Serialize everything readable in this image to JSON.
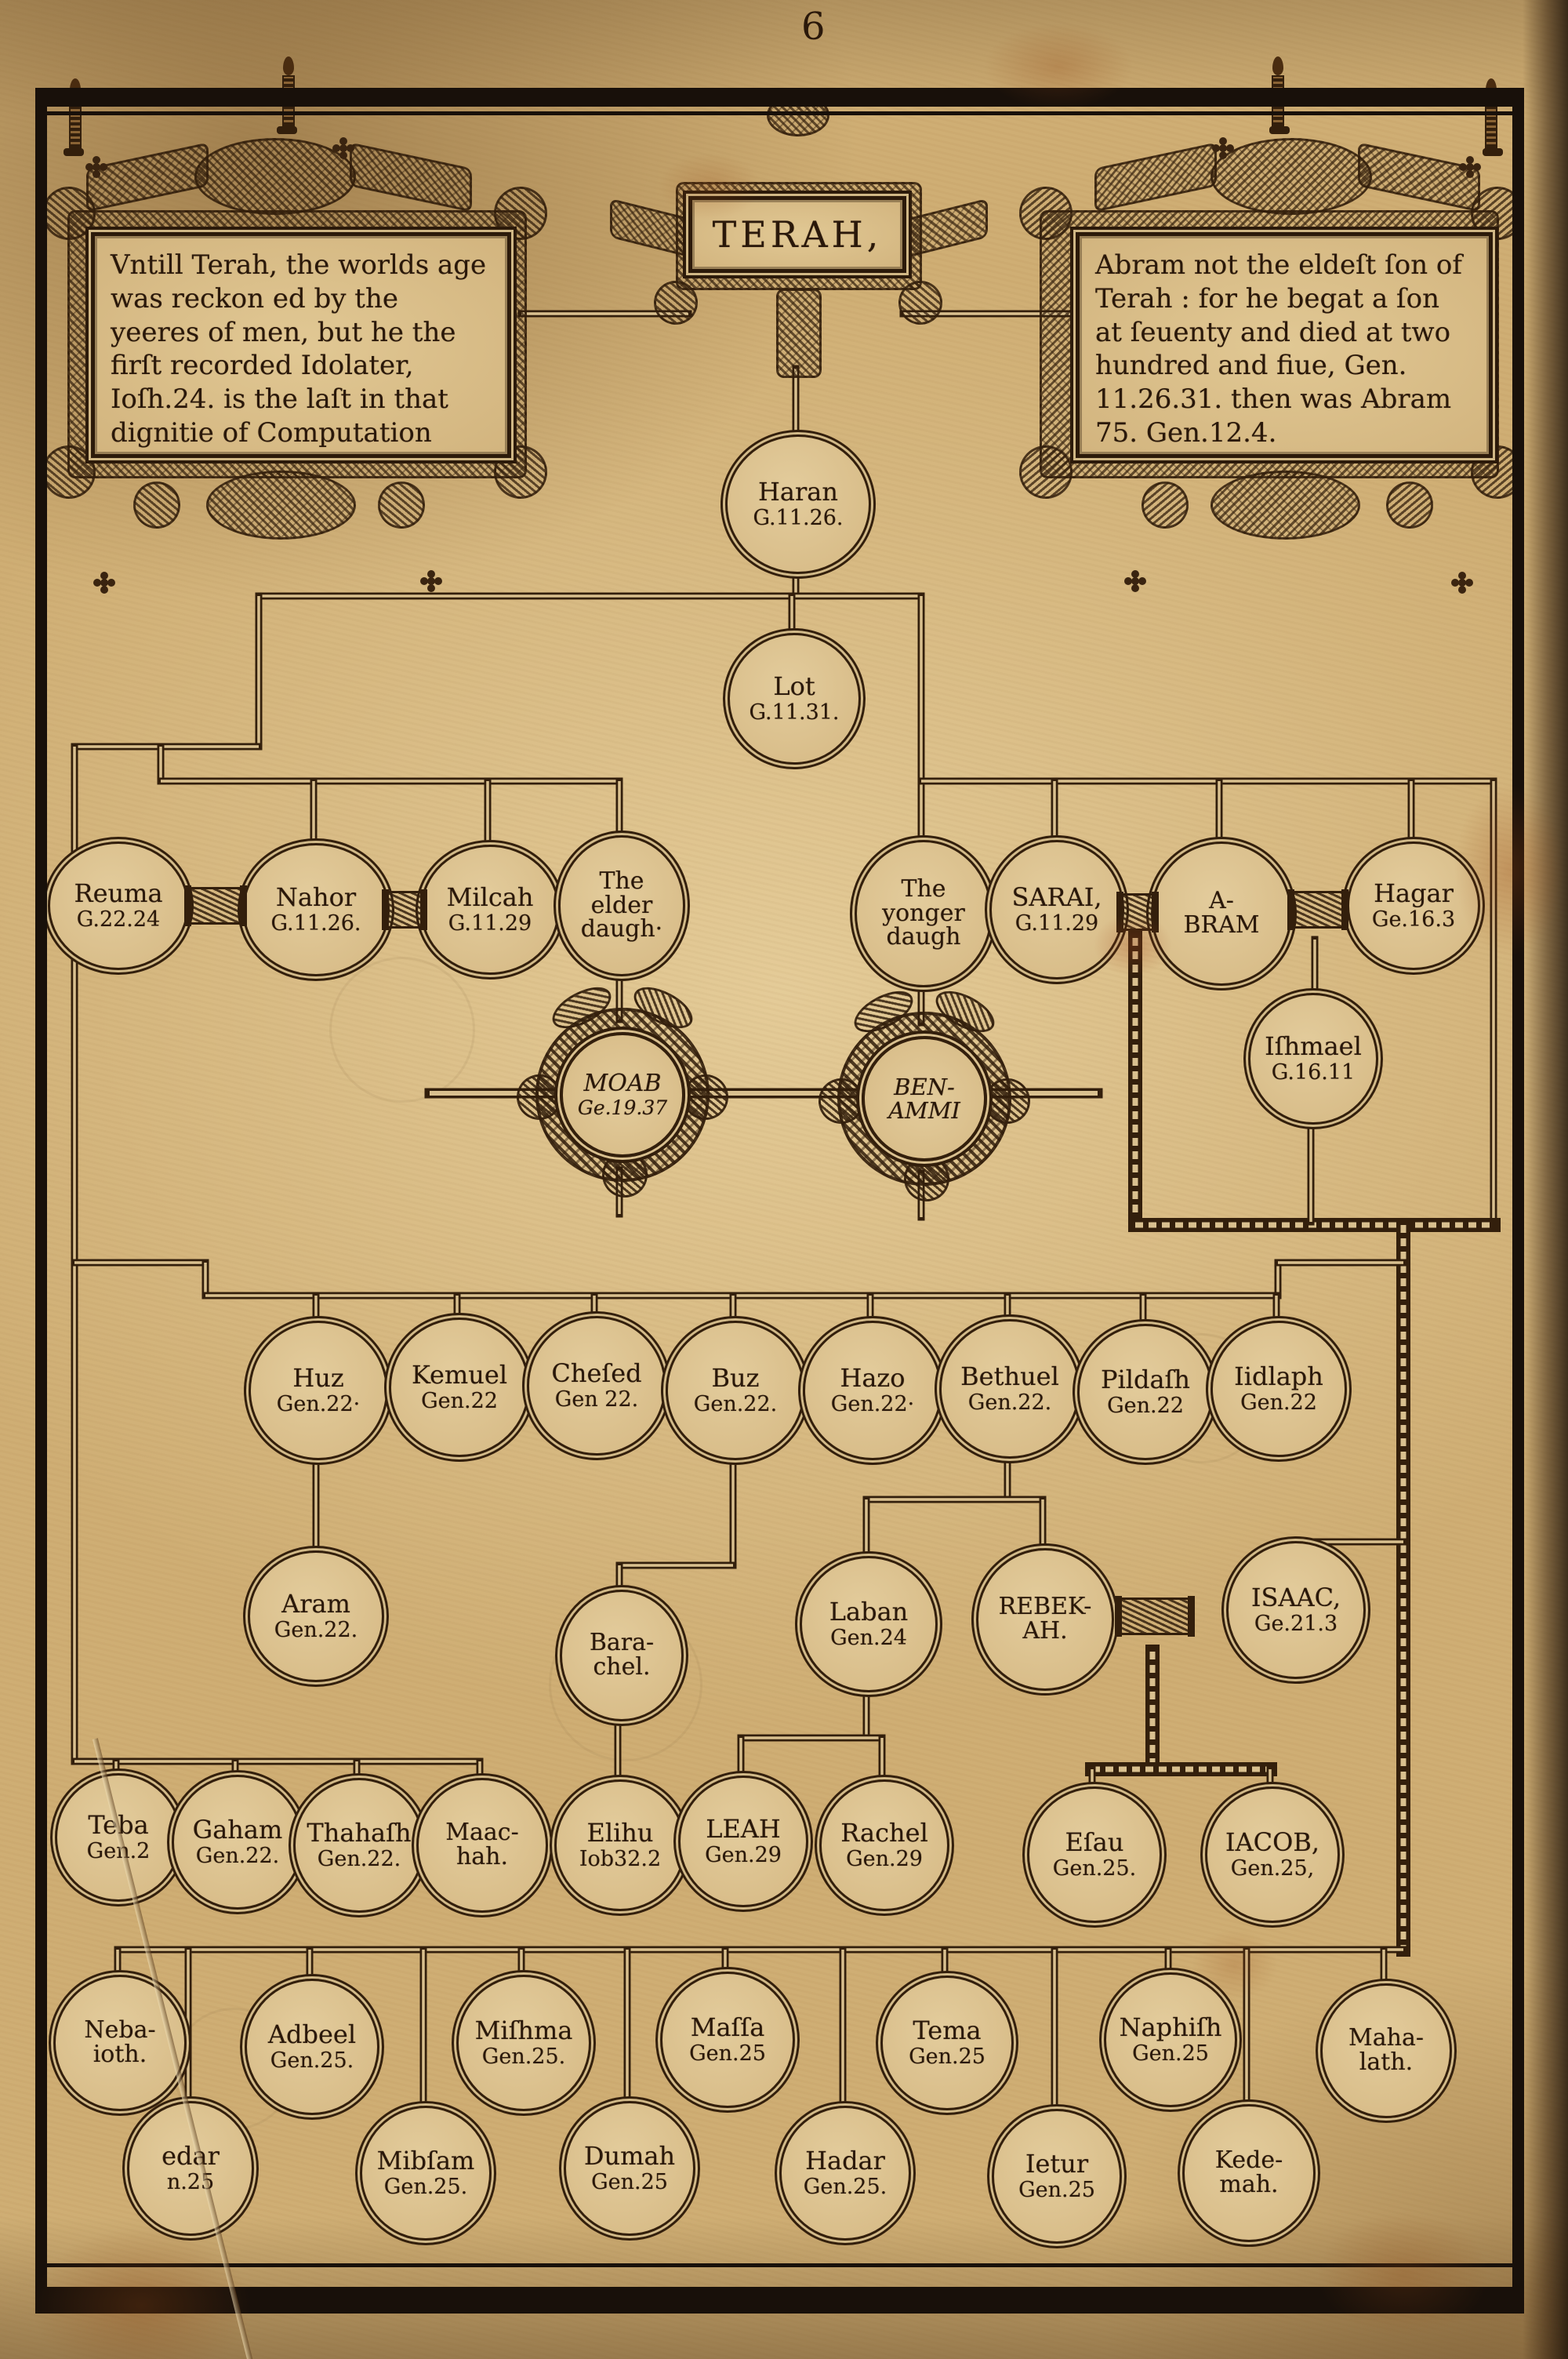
{
  "page": {
    "number": "6"
  },
  "banner": {
    "title": "TERAH,"
  },
  "notes": {
    "left": {
      "text": "Vntill Terah, the worlds age was reckon ed by the yeeres of men, but he the firſt recorded Idolater, Ioſh.24. is the laſt in that dignitie of Computation"
    },
    "right": {
      "text": "Abram not the eldeſt ſon of Terah : for he begat a ſon at ſeuenty and died at two hundred and fiue, Gen. 11.26.31. then was Abram 75. Gen.12.4."
    }
  },
  "icons": {
    "marriage": "clasped-hands"
  },
  "colors": {
    "ink": "#331f0c",
    "paper": "#d9c08f",
    "frame": "#18100a"
  },
  "tree": {
    "nodes": [
      {
        "id": "haran",
        "lines": [
          "Haran"
        ],
        "ref": "G.11.26."
      },
      {
        "id": "lot",
        "lines": [
          "Lot"
        ],
        "ref": "G.11.31."
      },
      {
        "id": "reuma",
        "lines": [
          "Reuma"
        ],
        "ref": "G.22.24"
      },
      {
        "id": "nahor",
        "lines": [
          "Nahor"
        ],
        "ref": "G.11.26."
      },
      {
        "id": "milcah",
        "lines": [
          "Milcah"
        ],
        "ref": "G.11.29"
      },
      {
        "id": "elder",
        "lines": [
          "The",
          "elder",
          "daugh·"
        ],
        "ref": ""
      },
      {
        "id": "yonger",
        "lines": [
          "The",
          "yonger",
          "daugh"
        ],
        "ref": ""
      },
      {
        "id": "sarai",
        "lines": [
          "SARAI,"
        ],
        "ref": "G.11.29"
      },
      {
        "id": "abram",
        "lines": [
          "A-",
          "BRAM"
        ],
        "ref": ""
      },
      {
        "id": "hagar",
        "lines": [
          "Hagar"
        ],
        "ref": "Ge.16.3"
      },
      {
        "id": "ishmael",
        "lines": [
          "Iſhmael"
        ],
        "ref": "G.16.11"
      },
      {
        "id": "moab",
        "lines": [
          "MOAB"
        ],
        "ref": "Ge.19.37"
      },
      {
        "id": "benammi",
        "lines": [
          "BEN-",
          "AMMI"
        ],
        "ref": ""
      },
      {
        "id": "huz",
        "lines": [
          "Huz"
        ],
        "ref": "Gen.22·"
      },
      {
        "id": "kemuel",
        "lines": [
          "Kemuel"
        ],
        "ref": "Gen.22"
      },
      {
        "id": "chesed",
        "lines": [
          "Cheſed"
        ],
        "ref": "Gen 22."
      },
      {
        "id": "buz",
        "lines": [
          "Buz"
        ],
        "ref": "Gen.22."
      },
      {
        "id": "hazo",
        "lines": [
          "Hazo"
        ],
        "ref": "Gen.22·"
      },
      {
        "id": "bethuel",
        "lines": [
          "Bethuel"
        ],
        "ref": "Gen.22."
      },
      {
        "id": "pildash",
        "lines": [
          "Pildaſh"
        ],
        "ref": "Gen.22"
      },
      {
        "id": "iidlaph",
        "lines": [
          "Iidlaph"
        ],
        "ref": "Gen.22"
      },
      {
        "id": "aram",
        "lines": [
          "Aram"
        ],
        "ref": "Gen.22."
      },
      {
        "id": "barachel",
        "lines": [
          "Bara-",
          "chel."
        ],
        "ref": ""
      },
      {
        "id": "laban",
        "lines": [
          "Laban"
        ],
        "ref": "Gen.24"
      },
      {
        "id": "rebekah",
        "lines": [
          "REBEK-",
          "AH."
        ],
        "ref": ""
      },
      {
        "id": "isaac",
        "lines": [
          "ISAAC,"
        ],
        "ref": "Ge.21.3"
      },
      {
        "id": "teba",
        "lines": [
          "Teba"
        ],
        "ref": "Gen.2"
      },
      {
        "id": "gaham",
        "lines": [
          "Gaham"
        ],
        "ref": "Gen.22."
      },
      {
        "id": "thahash",
        "lines": [
          "Thahaſh"
        ],
        "ref": "Gen.22."
      },
      {
        "id": "maachah",
        "lines": [
          "Maac-",
          "hah."
        ],
        "ref": ""
      },
      {
        "id": "elihu",
        "lines": [
          "Elihu"
        ],
        "ref": "Iob32.2"
      },
      {
        "id": "leah",
        "lines": [
          "LEAH"
        ],
        "ref": "Gen.29"
      },
      {
        "id": "rachel",
        "lines": [
          "Rachel"
        ],
        "ref": "Gen.29"
      },
      {
        "id": "esau",
        "lines": [
          "Eſau"
        ],
        "ref": "Gen.25."
      },
      {
        "id": "iacob",
        "lines": [
          "IACOB,"
        ],
        "ref": "Gen.25,"
      },
      {
        "id": "nebaioth",
        "lines": [
          "Neba-",
          "ioth."
        ],
        "ref": ""
      },
      {
        "id": "adbeel",
        "lines": [
          "Adbeel"
        ],
        "ref": "Gen.25."
      },
      {
        "id": "mishma",
        "lines": [
          "Miſhma"
        ],
        "ref": "Gen.25."
      },
      {
        "id": "massa",
        "lines": [
          "Maſſa"
        ],
        "ref": "Gen.25"
      },
      {
        "id": "tema",
        "lines": [
          "Tema"
        ],
        "ref": "Gen.25"
      },
      {
        "id": "naphish",
        "lines": [
          "Naphiſh"
        ],
        "ref": "Gen.25"
      },
      {
        "id": "mahalath",
        "lines": [
          "Maha-",
          "lath."
        ],
        "ref": ""
      },
      {
        "id": "kedar",
        "lines": [
          "edar"
        ],
        "ref": "n.25"
      },
      {
        "id": "mibsam",
        "lines": [
          "Mibſam"
        ],
        "ref": "Gen.25."
      },
      {
        "id": "dumah",
        "lines": [
          "Dumah"
        ],
        "ref": "Gen.25"
      },
      {
        "id": "hadar",
        "lines": [
          "Hadar"
        ],
        "ref": "Gen.25."
      },
      {
        "id": "ietur",
        "lines": [
          "Ietur"
        ],
        "ref": "Gen.25"
      },
      {
        "id": "kedemah",
        "lines": [
          "Kede-",
          "mah."
        ],
        "ref": ""
      }
    ]
  }
}
